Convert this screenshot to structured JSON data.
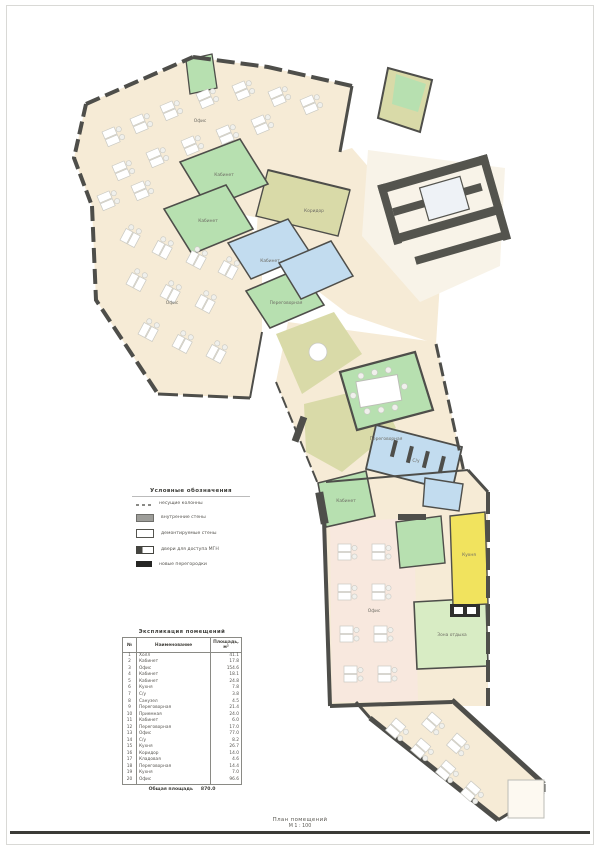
{
  "colors": {
    "wall": "#4e4e4a",
    "office_beige": "#f6ebd6",
    "office_pink": "#f8e8de",
    "meeting_green": "#b7e0b0",
    "lounge_green": "#d8ecc4",
    "cabinet_blue": "#c2dcef",
    "corridor_khaki": "#d9daa8",
    "kitchen_yellow": "#f1e35e"
  },
  "legend": {
    "title": "Условные обозначения",
    "items": [
      {
        "symbol": "dashes",
        "label": "несущие колонны"
      },
      {
        "symbol": "gray-rect",
        "label": "внутренние стены"
      },
      {
        "symbol": "outline-rect",
        "label": "демонтируемые стены"
      },
      {
        "symbol": "door",
        "label": "двери для доступа МГН"
      },
      {
        "symbol": "black-rect",
        "label": "новые перегородки"
      }
    ]
  },
  "schedule": {
    "title": "Экспликация помещений",
    "columns": [
      "№",
      "Наименование",
      "Площадь, м²"
    ],
    "rows": [
      [
        "1",
        "Холл",
        "41.1"
      ],
      [
        "2",
        "Кабинет",
        "17.8"
      ],
      [
        "3",
        "Офис",
        "154.6"
      ],
      [
        "4",
        "Кабинет",
        "18.1"
      ],
      [
        "5",
        "Кабинет",
        "24.8"
      ],
      [
        "6",
        "Кухня",
        "7.8"
      ],
      [
        "7",
        "С/у",
        "3.8"
      ],
      [
        "8",
        "Санузел",
        "4.5"
      ],
      [
        "9",
        "Переговорная",
        "21.4"
      ],
      [
        "10",
        "Приемная",
        "24.0"
      ],
      [
        "11",
        "Кабинет",
        "6.0"
      ],
      [
        "12",
        "Переговорная",
        "17.0"
      ],
      [
        "13",
        "Офис",
        "77.0"
      ],
      [
        "14",
        "С/у",
        "8.2"
      ],
      [
        "15",
        "Кухня",
        "26.7"
      ],
      [
        "16",
        "Коридор",
        "14.0"
      ],
      [
        "17",
        "Кладовая",
        "4.6"
      ],
      [
        "18",
        "Переговорная",
        "14.4"
      ],
      [
        "19",
        "Кухня",
        "7.0"
      ],
      [
        "20",
        "Офис",
        "96.6"
      ]
    ],
    "total_label": "Общая площадь",
    "total_value": "870.0"
  },
  "plan": {
    "labels": [
      {
        "text": "Офис",
        "x": 200,
        "y": 122
      },
      {
        "text": "Кабинет",
        "x": 224,
        "y": 176
      },
      {
        "text": "Кабинет",
        "x": 208,
        "y": 222
      },
      {
        "text": "Офис",
        "x": 172,
        "y": 304
      },
      {
        "text": "Кабинет",
        "x": 270,
        "y": 262
      },
      {
        "text": "Переговорная",
        "x": 286,
        "y": 304
      },
      {
        "text": "Коридор",
        "x": 314,
        "y": 212
      },
      {
        "text": "Переговорная",
        "x": 386,
        "y": 440
      },
      {
        "text": "Кабинет",
        "x": 346,
        "y": 502
      },
      {
        "text": "С/у",
        "x": 416,
        "y": 462
      },
      {
        "text": "Кухня",
        "x": 469,
        "y": 556
      },
      {
        "text": "Зона отдыха",
        "x": 452,
        "y": 636
      },
      {
        "text": "Офис",
        "x": 374,
        "y": 612
      }
    ]
  },
  "caption": {
    "line1": "План помещений",
    "line2": "М 1 : 100"
  }
}
